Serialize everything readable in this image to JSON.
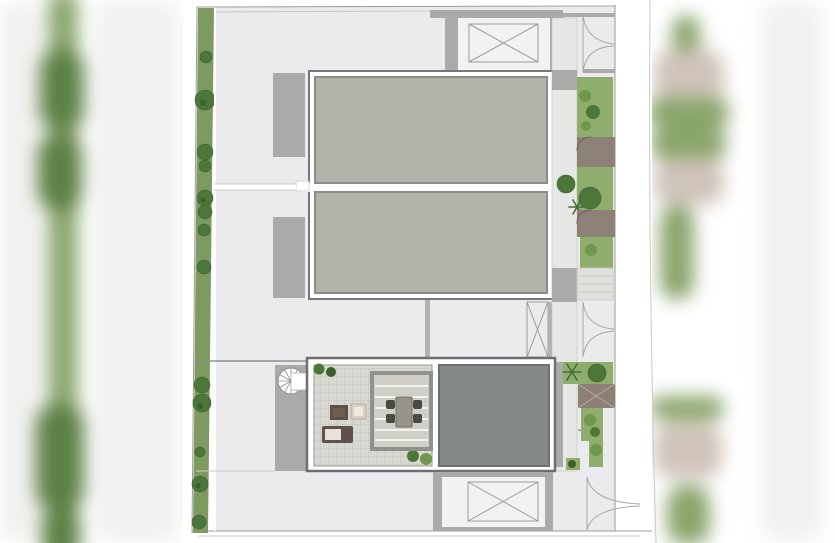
{
  "meta": {
    "kind": "architectural-roof-site-plan",
    "visible_text": "none",
    "orientation": "top-down plan view with blurred photo margins left and right"
  },
  "colors": {
    "page_bg": "#ffffff",
    "plan_bg": "#ebebed",
    "line": "#9b9b95",
    "faint": "#c9c9c4",
    "hedge": "#7d9a61",
    "tree": "#4c763a",
    "tree_dark": "#3c612d",
    "garden": "#8fae6e",
    "fern": "#6f974d",
    "slab": "#b2b3aa",
    "slab_border": "#8b8d85",
    "frame": "#75777a",
    "wall": "#a9aba8",
    "walkway": "#e7e7e6",
    "dark_slab": "#848887",
    "dark_border": "#6d706f",
    "tiles": "#d8d8d2",
    "tile_line": "#c3c3bb",
    "pergola": "#8f928c",
    "pergola_fill": "#cfcfc7",
    "porch": "#8e8178",
    "roof": "#8d7f74",
    "roof_line": "#b9aea2",
    "wood_dark": "#5f5149",
    "wood_mid": "#6e5d52",
    "cushion": "#e8e3d8",
    "beige": "#d9d0c1",
    "table": "#99948a",
    "chair": "#4a4a45",
    "steps": "#e0e0dd",
    "blur_green": "#8aa56c",
    "blur_tree": "#5d8045",
    "blur_taupe": "#cfc3ba",
    "smudge": "#f1f1ef"
  },
  "features": [
    "perimeter-hedge-with-street-trees",
    "plot-boundary-lines",
    "twin-beige-roof-slabs",
    "crossed-skylight-shaft-top",
    "crossed-skylight-shaft-bottom",
    "narrow-crossed-stair-shaft",
    "roof-terrace-tiled",
    "pergola-with-dining-table-and-four-chairs",
    "lounge-sofa-coffee-table-armchair",
    "spiral-staircase",
    "dark-gray-roof-slab",
    "side-walkway",
    "entry-porches-with-door-swings",
    "garden-strips-with-palms-and-shrubs",
    "hip-roof-entrance-canopy",
    "garden-steps",
    "curved-landscape-path-symbols",
    "blurred-photo-margin-left",
    "blurred-photo-margin-right"
  ]
}
